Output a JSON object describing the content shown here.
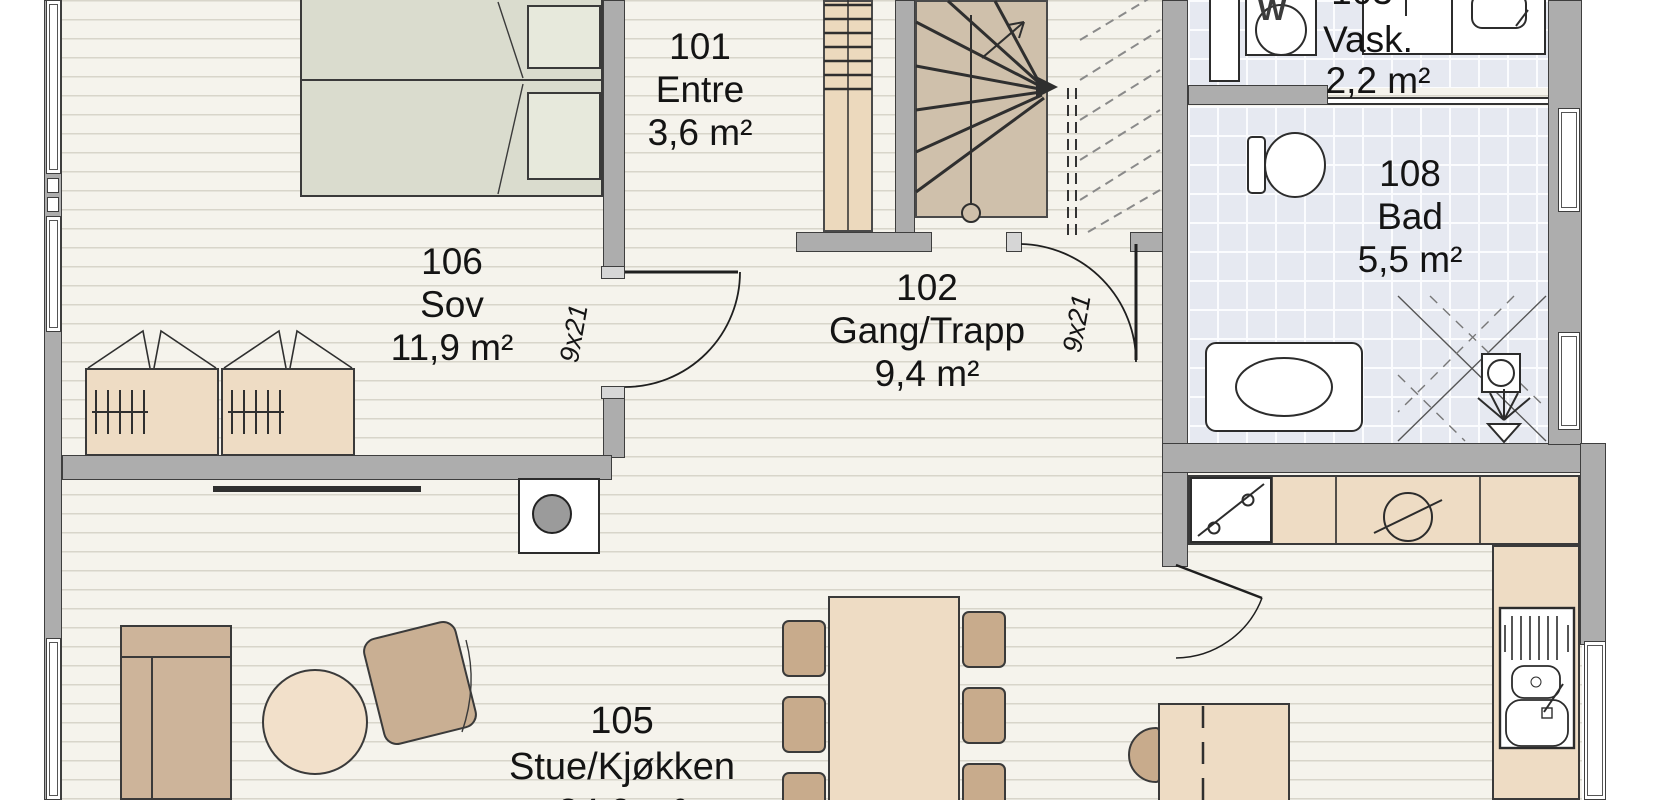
{
  "plan": {
    "type": "architectural-floor-plan",
    "language": "Norwegian",
    "rooms": [
      {
        "number": "101",
        "name": "Entre",
        "area": "3,6 m²"
      },
      {
        "number": "102",
        "name": "Gang/Trapp",
        "area": "9,4 m²"
      },
      {
        "number": "105",
        "name": "Stue/Kjøkken",
        "area": "34,9 m²",
        "note": "area line clipped at bottom edge"
      },
      {
        "number": "106",
        "name": "Sov",
        "area": "11,9 m²"
      },
      {
        "number": "108",
        "name": "Bad",
        "area": "5,5 m²"
      },
      {
        "number": "103",
        "name": "Vask.",
        "area": "2,2 m²",
        "note": "number clipped at top edge"
      }
    ],
    "doors": [
      {
        "label": "9x21",
        "location": "between Sov and Gang"
      },
      {
        "label": "9x21",
        "location": "between Gang and Bad/Vask corridor"
      }
    ],
    "appliances": {
      "washer_label": "W"
    },
    "furniture": [
      "double-bed",
      "wardrobes",
      "winder-staircase",
      "straight-stair-flight",
      "washing-machine",
      "laundry-counter-sink",
      "toilet",
      "vanity-sink",
      "shower",
      "kitchen-counter",
      "dishwasher",
      "cooktop-sink-symbol",
      "kitchen-sink-unit",
      "fireplace",
      "tv",
      "sofa",
      "coffee-table",
      "armchair",
      "dining-table",
      "dining-chairs",
      "desk",
      "desk-chair"
    ],
    "colors": {
      "wall": "#adadad",
      "wood_floor": "#f5f3ec",
      "plank_line": "#d8d5ca",
      "tile_floor": "#e6e9f1",
      "furniture_light_tan": "#eedcc4",
      "furniture_dark_tan": "#c8ab8c",
      "bed_green": "#dadcce",
      "stair_tan": "#cfc0ab",
      "stair_column_tan": "#ecd9bd",
      "line_dark": "#2f2f2f"
    }
  }
}
